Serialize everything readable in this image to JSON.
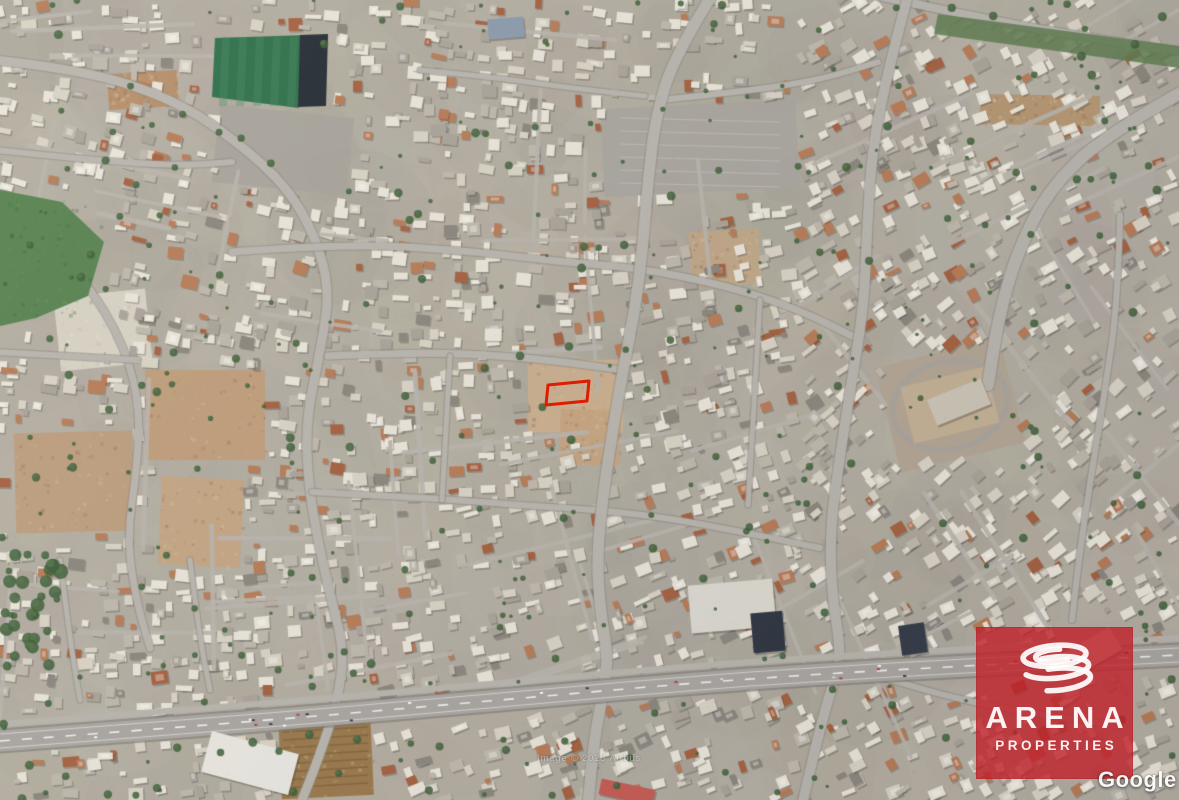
{
  "map": {
    "type": "satellite",
    "description": "Aerial satellite view of a dense Mediterranean town with a highway across the bottom, a football pitch top-left and empty dirt plots",
    "plot": {
      "label": "property-plot-outline",
      "outline_color": "#e01b00",
      "points": "548,385 589,381 587,401 546,405"
    }
  },
  "logo": {
    "title": "ARENA",
    "subtitle": "PROPERTIES",
    "background_color": "#c2202a",
    "icon": "arena-rings-icon"
  },
  "watermarks": {
    "google": "Google",
    "attribution": "Image © 2023 Airbus"
  }
}
